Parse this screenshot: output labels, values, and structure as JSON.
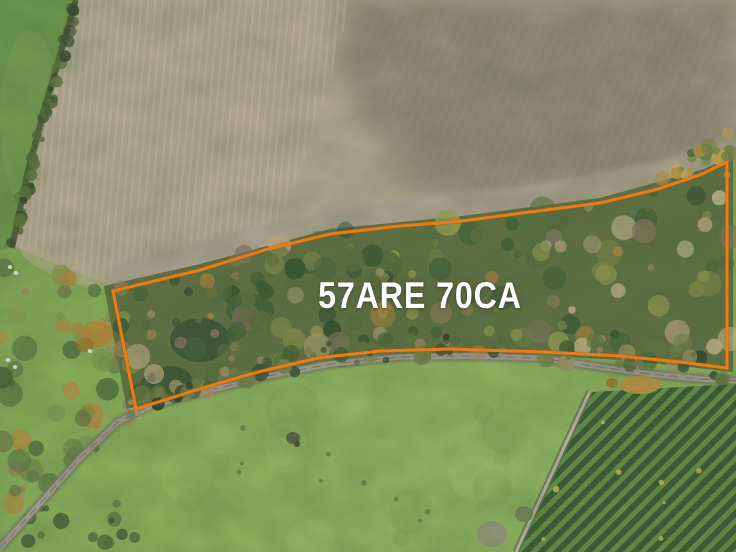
{
  "overlay": {
    "area_label": "57ARE 70CA",
    "label_color": "#ffffff",
    "boundary_color": "#e87c18",
    "boundary_halo_color": "#a05a10",
    "boundary_width": 3,
    "boundary_points": "113,291 200,270 268,249 330,234 400,226 462,221 530,212 600,203 658,189 702,174 727,162 727,368 680,362 620,356 545,352 450,349 380,351 318,358 258,372 196,390 136,409"
  },
  "palette": {
    "field_light": "#ada18a",
    "field_dark": "#8b8170",
    "field_stubble": "#9d9383",
    "furrow_line": "#c6b8a2",
    "grass_upper": "#639043",
    "meadow": "#84aa55",
    "meadow_deep": "#6f9447",
    "scrub_base": "#57693b",
    "path_grey": "#9b958c",
    "path_edge": "#6e7158",
    "vineyard_dark": "#2f5229",
    "vineyard_light": "#5d8840",
    "hedgerow_dark": "#45502f",
    "autumn_orange": "#b5812f"
  }
}
